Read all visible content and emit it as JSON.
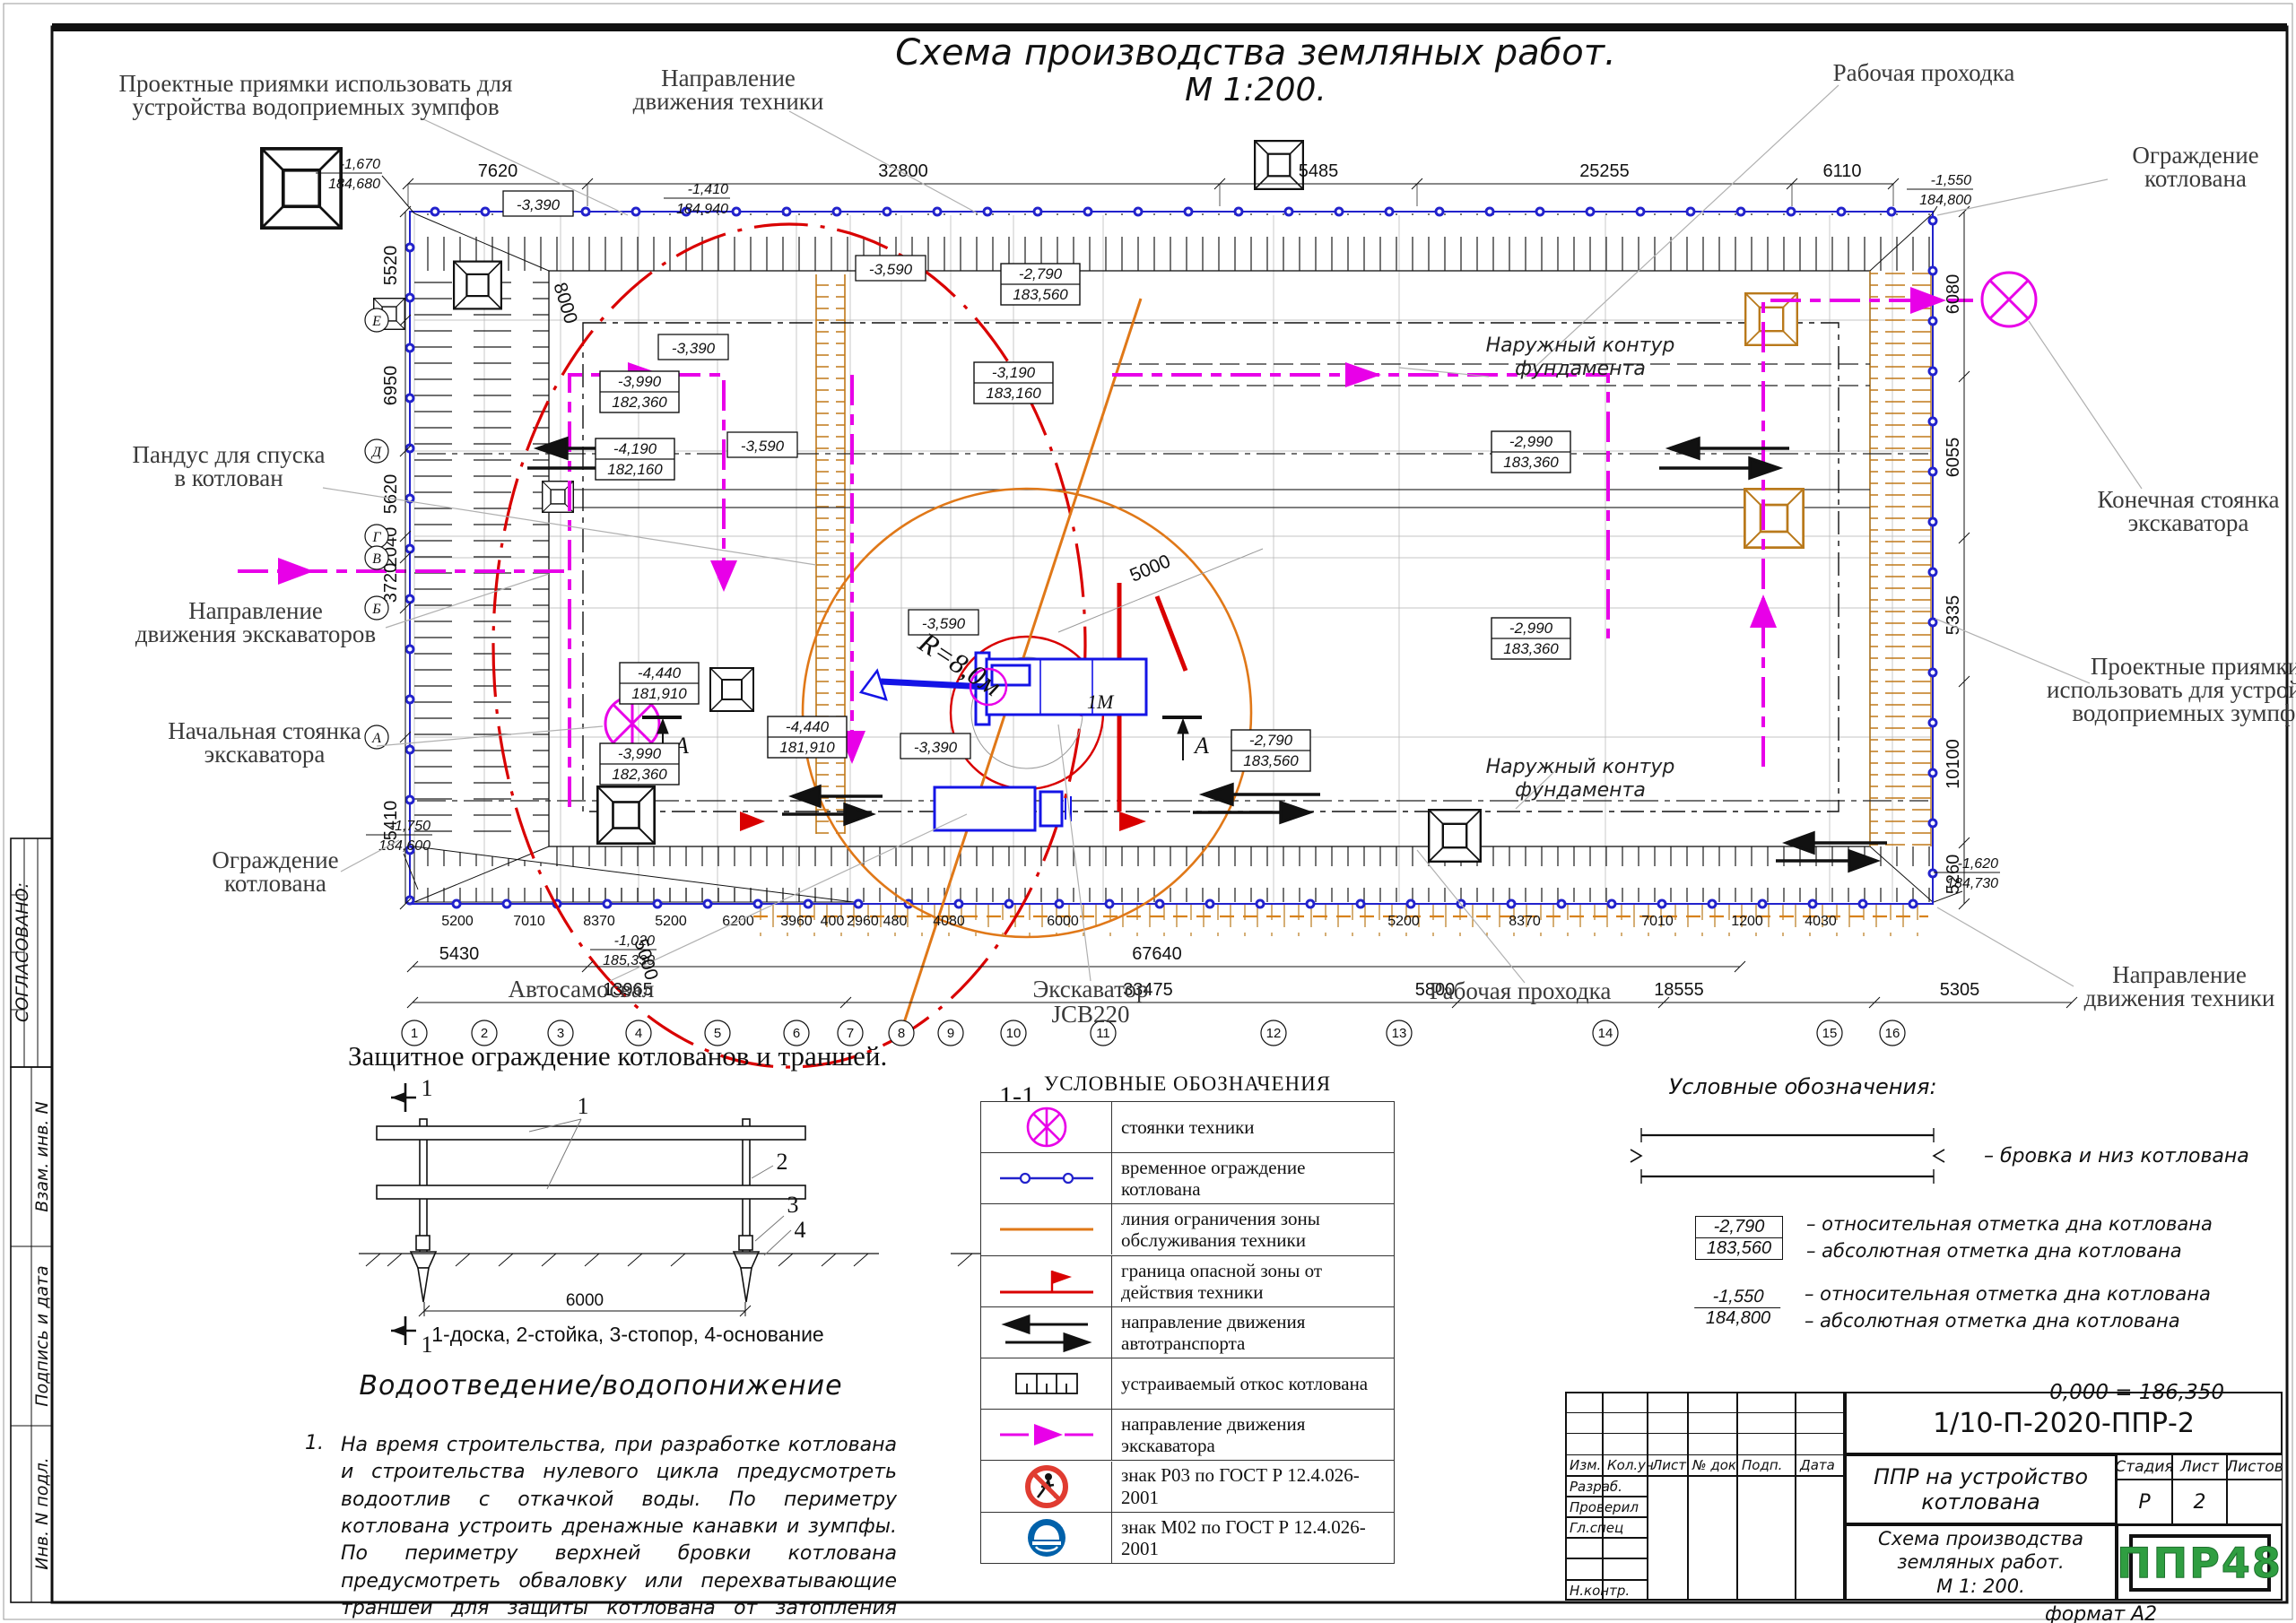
{
  "sheet": {
    "title": "Схема производства земляных работ.",
    "scale": "М 1:200.",
    "format_note": "формат А2"
  },
  "sidebar": {
    "approved": "СОГЛАСОВАНО:",
    "stamps": [
      "Взам. инв. N",
      "Подпись и дата",
      "Инв. N подл."
    ]
  },
  "callouts": {
    "pits_tl": [
      "Проектные приямки использовать для",
      "устройства водоприемных зумпфов"
    ],
    "tech_dir_top": [
      "Направление",
      "движения техники"
    ],
    "prohodka_top": "Рабочая проходка",
    "fence_tr": [
      "Ограждение",
      "котлована"
    ],
    "ramp": [
      "Пандус для спуска",
      "в котлован"
    ],
    "excav_dir": [
      "Направление",
      "движения экскаваторов"
    ],
    "start_parking": [
      "Начальная стоянка",
      "экскаватора"
    ],
    "fence_bl": [
      "Ограждение",
      "котлована"
    ],
    "end_parking": [
      "Конечная стоянка",
      "экскаватора"
    ],
    "pits_right": [
      "Проектные приямки",
      "использовать для устройства",
      "водоприемных зумпфов"
    ],
    "tech_dir_bottom": [
      "Направление",
      "движения техники"
    ],
    "prohodka_bottom": "Рабочая проходка",
    "truck": "Автосамосвал",
    "excavator": [
      "Экскаватор",
      "JCB220"
    ],
    "foundation_top": [
      "Наружный контур",
      "фундамента"
    ],
    "foundation_bottom": [
      "Наружный контур",
      "фундамента"
    ],
    "radius": "R=8,0м",
    "one_m": "1М",
    "swing": "5000",
    "pass": "5000",
    "ramp_len": "8000",
    "section": "А"
  },
  "plan": {
    "dims_top": [
      "7620",
      "32800",
      "5485",
      "25255",
      "6110"
    ],
    "dims_left": [
      "5520",
      "6950",
      "5620",
      "2040",
      "3720",
      "5410"
    ],
    "dims_right": [
      "6080",
      "6055",
      "5335",
      "10100",
      "5260"
    ],
    "dims_bottom": [
      "5200",
      "7010",
      "8370",
      "5200",
      "6200",
      "3960",
      "400",
      "2960",
      "480",
      "4080",
      "6000",
      "5200",
      "8370",
      "7010",
      "1200",
      "4030"
    ],
    "dims_bottom_mid": [
      "5430",
      "67640"
    ],
    "dims_bottom_total": [
      "13965",
      "33475",
      "5800",
      "18555",
      "5305"
    ],
    "axes_bottom": [
      "1",
      "2",
      "3",
      "4",
      "5",
      "6",
      "7",
      "8",
      "9",
      "10",
      "11",
      "12",
      "13",
      "14",
      "15",
      "16"
    ],
    "axes_left": [
      "Е",
      "Д",
      "Г",
      "В",
      "Б",
      "А"
    ],
    "corner_marks": {
      "tl": {
        "rel": "-1,670",
        "abs": "184,680"
      },
      "tc": {
        "rel": "-1,410",
        "abs": "184,940"
      },
      "tr": {
        "rel": "-1,550",
        "abs": "184,800"
      },
      "bl": {
        "rel": "-1,750",
        "abs": "184,600"
      },
      "br": {
        "rel": "-1,620",
        "abs": "184,730"
      },
      "b2": {
        "rel": "-1,020",
        "abs": "185,330"
      }
    },
    "elev_boxed": [
      {
        "rel": "-3,990",
        "abs": "182,360"
      },
      {
        "rel": "-4,190",
        "abs": "182,160"
      },
      {
        "rel": "-4,440",
        "abs": "181,910"
      },
      {
        "rel": "-4,440",
        "abs": "181,910"
      },
      {
        "rel": "-3,990",
        "abs": "182,360"
      },
      {
        "rel": "-3,190",
        "abs": "183,160"
      },
      {
        "rel": "-2,790",
        "abs": "183,560"
      },
      {
        "rel": "-2,790",
        "abs": "183,560"
      },
      {
        "rel": "-2,990",
        "abs": "183,360"
      },
      {
        "rel": "-2,990",
        "abs": "183,360"
      }
    ],
    "elev_single": [
      "-3,390",
      "-3,390",
      "-3,590",
      "-3,590",
      "-3,590",
      "-3,390"
    ]
  },
  "fence_detail": {
    "title": "Защитное ограждение котлованов и траншей.",
    "section_cut": "1",
    "section_view": "1-1",
    "span": "6000",
    "height": "1200",
    "depth": "400",
    "parts": [
      "1",
      "2",
      "3",
      "4"
    ],
    "caption": "1-доска, 2-стойка, 3-стопор, 4-основание"
  },
  "legend_left": {
    "title": "УСЛОВНЫЕ ОБОЗНАЧЕНИЯ",
    "rows": [
      {
        "icon": "parking-symbol",
        "text": "стоянки техники"
      },
      {
        "icon": "temp-fence-symbol",
        "text": "временное ограждение котлована"
      },
      {
        "icon": "service-zone-symbol",
        "text": "линия ограничения зоны обслуживания техники"
      },
      {
        "icon": "danger-zone-symbol",
        "text": "граница опасной зоны от действия техники"
      },
      {
        "icon": "traffic-direction-symbol",
        "text": "направление движения автотранспорта"
      },
      {
        "icon": "slope-symbol",
        "text": "устраиваемый откос котлована"
      },
      {
        "icon": "excavator-direction-symbol",
        "text": "направление движения экскаватора"
      },
      {
        "icon": "sign-p03-symbol",
        "text": "знак Р03 по ГОСТ Р 12.4.026-2001"
      },
      {
        "icon": "sign-m02-symbol",
        "text": "знак М02 по ГОСТ Р 12.4.026-2001"
      }
    ]
  },
  "legend_right": {
    "title": "Условные обозначения:",
    "brovka": "–  бровка и низ котлована",
    "mark_boxed": {
      "rel": "-2,790",
      "abs": "183,560"
    },
    "rel_desc": "–  относительная отметка дна котлована",
    "abs_desc": "–  абсолютная отметка дна котлована",
    "mark_plain": {
      "rel": "-1,550",
      "abs": "184,800"
    },
    "rel_desc2": "–  относительная отметка дна котлована",
    "abs_desc2": "–  абсолютная отметка дна котлована",
    "zero": "0,000 = 186,350"
  },
  "drainage": {
    "title": "Водоотведение/водопонижение",
    "item_no": "1.",
    "text": "На время строительства, при разработке котлована и строительства нулевого цикла предусмотреть водоотлив с откачкой воды. По периметру котлована устроить дренажные канавки и зумпфы. По периметру верхней бровки котлована предусмотреть обваловку или перехватывающие траншеи для защиты котлована от затопления поверхностными водами."
  },
  "titleblock": {
    "doc_number": "1/10-П-2020-ППР-2",
    "cols": [
      "Изм.",
      "Кол.уч",
      "Лист",
      "№ док",
      "Подп.",
      "Дата"
    ],
    "rows": [
      "Разраб.",
      "Проверил",
      "Гл.спец",
      "Н.контр."
    ],
    "object_title": "ППР на устройство котлована",
    "stage_label": "Стадия",
    "sheet_label": "Лист",
    "sheets_label": "Листов",
    "stage": "Р",
    "sheet_no": "2",
    "drawing_title": [
      "Схема производства",
      "земляных работ.",
      "М 1: 200."
    ],
    "logo": "ППР48"
  },
  "colors": {
    "fence_blue": "#2222cc",
    "machine_blue": "#1414e6",
    "magenta": "#e800e8",
    "orange": "#e07818",
    "red": "#d90000",
    "logo_green": "#2f9e41"
  }
}
